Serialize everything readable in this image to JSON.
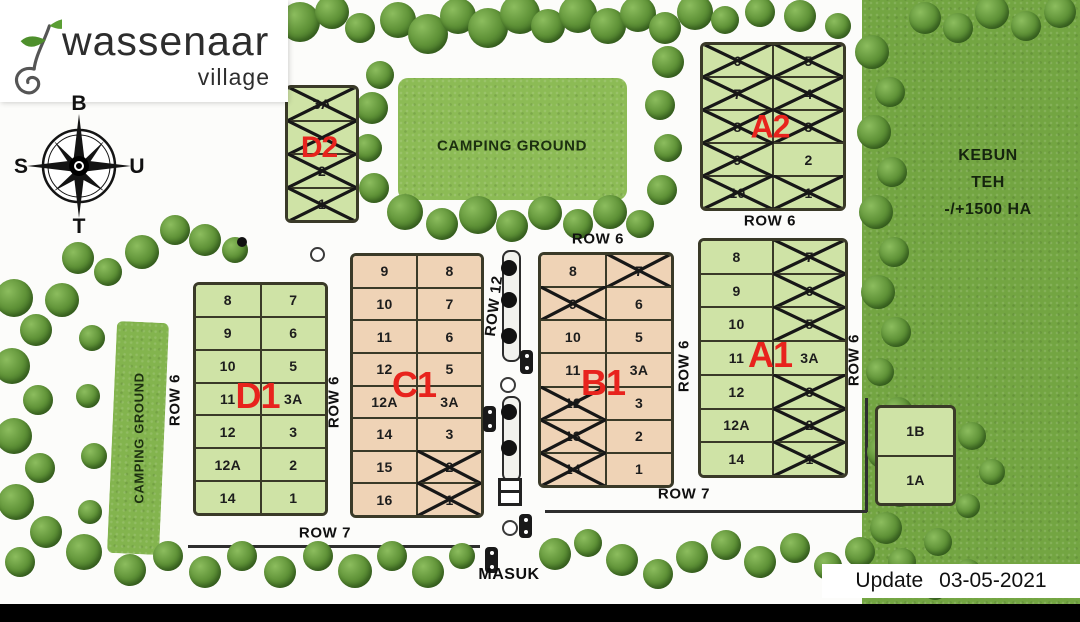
{
  "brand": {
    "title": "wassenaar",
    "subtitle": "village"
  },
  "icons": {
    "logo": "sprout-icon",
    "compass": "compass-rose-icon",
    "street_light": "lamp-post-icon"
  },
  "compass": {
    "top": "B",
    "left": "S",
    "right": "U",
    "bottom": "T"
  },
  "areas": {
    "camping_top": "CAMPING GROUND",
    "camping_left": "CAMPING GROUND",
    "kebun_line1": "KEBUN TEH",
    "kebun_line2": "-/+1500 HA"
  },
  "entrance": "MASUK",
  "update": {
    "label": "Update",
    "date": "03-05-2021"
  },
  "row_labels": {
    "d1_left": "ROW 6",
    "d1_right": "ROW 6",
    "d1_bottom": "ROW 7",
    "c1_right": "ROW 12",
    "b1_top": "ROW 6",
    "b1_right": "ROW 6",
    "b1_bottom": "ROW 7",
    "a1_top": "ROW 6",
    "a1_right": "ROW 6"
  },
  "colors": {
    "plot_green": "#cfe3a6",
    "plot_tan": "#efd3b6",
    "block_label_red": "#e8231d",
    "plot_border": "#3a3a28"
  },
  "blocks": [
    {
      "id": "D2",
      "label": "D2",
      "palette": "green",
      "columns": [
        [
          {
            "n": "3A",
            "x": true
          },
          {
            "n": "",
            "x": true
          },
          {
            "n": "2",
            "x": true
          },
          {
            "n": "1",
            "x": true
          }
        ]
      ]
    },
    {
      "id": "A2",
      "label": "A2",
      "palette": "green",
      "columns": [
        [
          {
            "n": "6",
            "x": true
          },
          {
            "n": "7",
            "x": true
          },
          {
            "n": "8",
            "x": true
          },
          {
            "n": "9",
            "x": true
          },
          {
            "n": "10",
            "x": true
          }
        ],
        [
          {
            "n": "5",
            "x": true
          },
          {
            "n": "4",
            "x": true
          },
          {
            "n": "3",
            "x": true
          },
          {
            "n": "2",
            "x": false
          },
          {
            "n": "1",
            "x": true
          }
        ]
      ]
    },
    {
      "id": "D1",
      "label": "D1",
      "palette": "green",
      "columns": [
        [
          {
            "n": "8"
          },
          {
            "n": "9"
          },
          {
            "n": "10"
          },
          {
            "n": "11"
          },
          {
            "n": "12"
          },
          {
            "n": "12A"
          },
          {
            "n": "14"
          }
        ],
        [
          {
            "n": "7"
          },
          {
            "n": "6"
          },
          {
            "n": "5"
          },
          {
            "n": "3A"
          },
          {
            "n": "3"
          },
          {
            "n": "2"
          },
          {
            "n": "1"
          }
        ]
      ]
    },
    {
      "id": "C1",
      "label": "C1",
      "palette": "tan",
      "columns": [
        [
          {
            "n": "9"
          },
          {
            "n": "10"
          },
          {
            "n": "11"
          },
          {
            "n": "12"
          },
          {
            "n": "12A"
          },
          {
            "n": "14"
          },
          {
            "n": "15"
          },
          {
            "n": "16"
          }
        ],
        [
          {
            "n": "8"
          },
          {
            "n": "7"
          },
          {
            "n": "6"
          },
          {
            "n": "5"
          },
          {
            "n": "3A"
          },
          {
            "n": "3"
          },
          {
            "n": "2",
            "x": true
          },
          {
            "n": "1",
            "x": true
          }
        ]
      ]
    },
    {
      "id": "B1",
      "label": "B1",
      "palette": "tan",
      "columns": [
        [
          {
            "n": "8"
          },
          {
            "n": "9",
            "x": true
          },
          {
            "n": "10"
          },
          {
            "n": "11"
          },
          {
            "n": "12",
            "x": true
          },
          {
            "n": "13",
            "x": true
          },
          {
            "n": "14",
            "x": true
          }
        ],
        [
          {
            "n": "7",
            "x": true
          },
          {
            "n": "6"
          },
          {
            "n": "5"
          },
          {
            "n": "3A"
          },
          {
            "n": "3"
          },
          {
            "n": "2"
          },
          {
            "n": "1"
          }
        ]
      ]
    },
    {
      "id": "A1",
      "label": "A1",
      "palette": "green",
      "columns": [
        [
          {
            "n": "8"
          },
          {
            "n": "9"
          },
          {
            "n": "10"
          },
          {
            "n": "11"
          },
          {
            "n": "12"
          },
          {
            "n": "12A"
          },
          {
            "n": "14"
          }
        ],
        [
          {
            "n": "7",
            "x": true
          },
          {
            "n": "6",
            "x": true
          },
          {
            "n": "5",
            "x": true
          },
          {
            "n": "3A",
            "x": false
          },
          {
            "n": "3",
            "x": true
          },
          {
            "n": "2",
            "x": true
          },
          {
            "n": "1",
            "x": true
          }
        ]
      ]
    },
    {
      "id": "AB",
      "label": "",
      "palette": "green",
      "columns": [
        [
          {
            "n": "1B"
          },
          {
            "n": "1A"
          }
        ]
      ]
    }
  ]
}
